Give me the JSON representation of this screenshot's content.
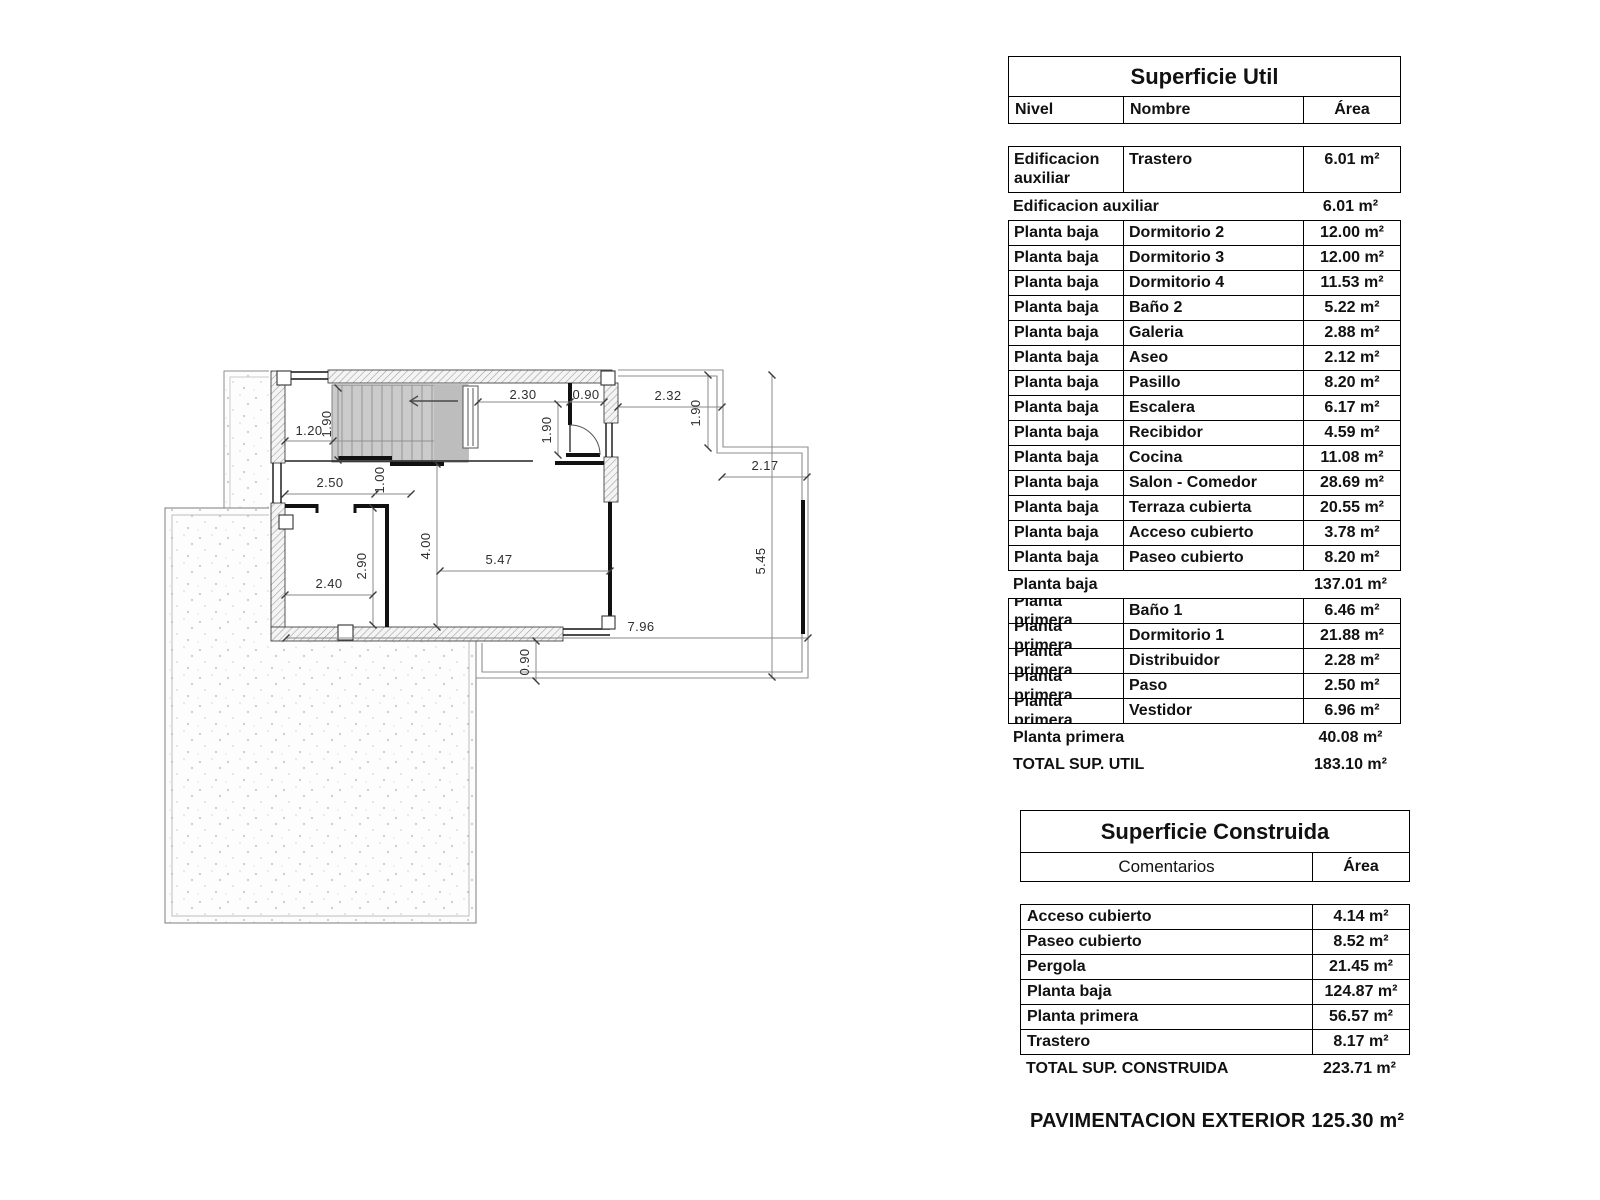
{
  "plan": {
    "dims": {
      "stair_room_width": "1.20",
      "stair_flight_width": "1.90",
      "hall_top_width": "2.30",
      "entry_door_width": "0.90",
      "vestibule_depth": "1.90",
      "porch_width": "2.32",
      "porch_depth": "1.90",
      "terrace_step_width": "2.17",
      "room_top_width": "2.50",
      "interior_door_width": "1.00",
      "hall_depth": "4.00",
      "salon_width": "5.47",
      "room_depth": "2.90",
      "room_bottom_width": "2.40",
      "terrace_depth": "5.45",
      "building_width": "7.96",
      "walkway_depth": "0.90"
    }
  },
  "superficie_util": {
    "title": "Superficie Util",
    "columns": {
      "nivel": "Nivel",
      "nombre": "Nombre",
      "area": "Área"
    },
    "rows": [
      {
        "type": "detail",
        "tall": true,
        "nivel": "Edificacion auxiliar",
        "nombre": "Trastero",
        "area": "6.01 m²"
      },
      {
        "type": "summary",
        "label": "Edificacion auxiliar",
        "area": "6.01 m²"
      },
      {
        "type": "detail",
        "nivel": "Planta baja",
        "nombre": "Dormitorio 2",
        "area": "12.00 m²"
      },
      {
        "type": "detail",
        "nivel": "Planta baja",
        "nombre": "Dormitorio 3",
        "area": "12.00 m²"
      },
      {
        "type": "detail",
        "nivel": "Planta baja",
        "nombre": "Dormitorio 4",
        "area": "11.53 m²"
      },
      {
        "type": "detail",
        "nivel": "Planta baja",
        "nombre": "Baño 2",
        "area": "5.22 m²"
      },
      {
        "type": "detail",
        "nivel": "Planta baja",
        "nombre": "Galeria",
        "area": "2.88 m²"
      },
      {
        "type": "detail",
        "nivel": "Planta baja",
        "nombre": "Aseo",
        "area": "2.12 m²"
      },
      {
        "type": "detail",
        "nivel": "Planta baja",
        "nombre": "Pasillo",
        "area": "8.20 m²"
      },
      {
        "type": "detail",
        "nivel": "Planta baja",
        "nombre": "Escalera",
        "area": "6.17 m²"
      },
      {
        "type": "detail",
        "nivel": "Planta baja",
        "nombre": "Recibidor",
        "area": "4.59 m²"
      },
      {
        "type": "detail",
        "nivel": "Planta baja",
        "nombre": "Cocina",
        "area": "11.08 m²"
      },
      {
        "type": "detail",
        "nivel": "Planta baja",
        "nombre": "Salon - Comedor",
        "area": "28.69 m²"
      },
      {
        "type": "detail",
        "nivel": "Planta baja",
        "nombre": "Terraza cubierta",
        "area": "20.55 m²"
      },
      {
        "type": "detail",
        "nivel": "Planta baja",
        "nombre": "Acceso cubierto",
        "area": "3.78 m²"
      },
      {
        "type": "detail",
        "nivel": "Planta baja",
        "nombre": "Paseo cubierto",
        "area": "8.20 m²"
      },
      {
        "type": "summary",
        "label": "Planta baja",
        "area": "137.01 m²"
      },
      {
        "type": "detail",
        "nivel": "Planta primera",
        "nombre": "Baño 1",
        "area": "6.46 m²"
      },
      {
        "type": "detail",
        "nivel": "Planta primera",
        "nombre": "Dormitorio 1",
        "area": "21.88 m²"
      },
      {
        "type": "detail",
        "nivel": "Planta primera",
        "nombre": "Distribuidor",
        "area": "2.28 m²"
      },
      {
        "type": "detail",
        "nivel": "Planta primera",
        "nombre": "Paso",
        "area": "2.50 m²"
      },
      {
        "type": "detail",
        "nivel": "Planta primera",
        "nombre": "Vestidor",
        "area": "6.96 m²"
      },
      {
        "type": "summary",
        "label": "Planta primera",
        "area": "40.08 m²"
      },
      {
        "type": "total",
        "label": "TOTAL SUP. UTIL",
        "area": "183.10 m²"
      }
    ]
  },
  "superficie_construida": {
    "title": "Superficie Construida",
    "columns": {
      "comentarios": "Comentarios",
      "area": "Área"
    },
    "rows": [
      {
        "type": "detail",
        "label": "Acceso cubierto",
        "area": "4.14 m²"
      },
      {
        "type": "detail",
        "label": "Paseo cubierto",
        "area": "8.52 m²"
      },
      {
        "type": "detail",
        "label": "Pergola",
        "area": "21.45 m²"
      },
      {
        "type": "detail",
        "label": "Planta baja",
        "area": "124.87 m²"
      },
      {
        "type": "detail",
        "label": "Planta primera",
        "area": "56.57 m²"
      },
      {
        "type": "detail",
        "label": "Trastero",
        "area": "8.17 m²"
      },
      {
        "type": "total",
        "label": "TOTAL SUP. CONSTRUIDA",
        "area": "223.71 m²"
      }
    ]
  },
  "footer": {
    "pavimentacion": "PAVIMENTACION EXTERIOR 125.30 m²"
  }
}
